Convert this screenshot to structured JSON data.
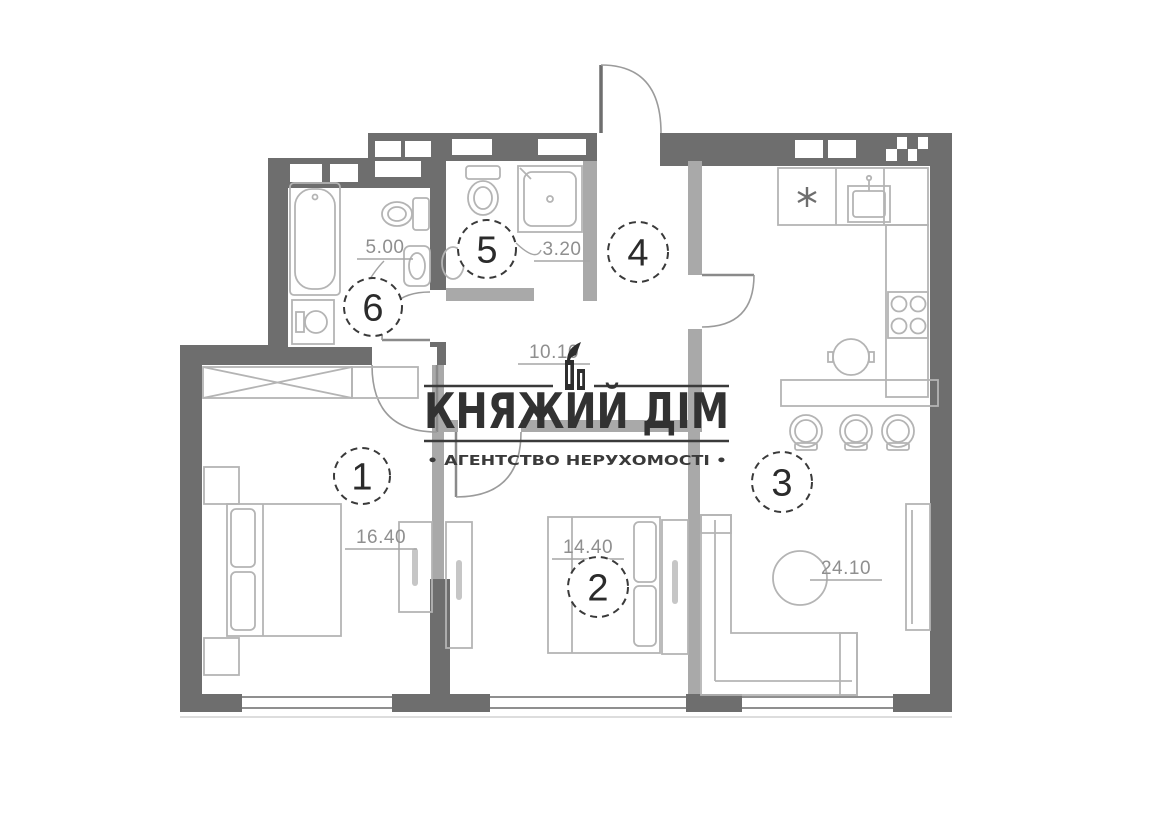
{
  "watermark": {
    "brand": "КНЯЖИЙ ДІМ",
    "tagline": "• АГЕНТСТВО НЕРУХОМОСТІ •",
    "icon": "building-towers-icon",
    "text_color": "#323232"
  },
  "floorplan": {
    "rooms": [
      {
        "number": "1",
        "area": "16.40"
      },
      {
        "number": "2",
        "area": "14.40"
      },
      {
        "number": "3",
        "area": "24.10"
      },
      {
        "number": "4",
        "area": "10.10"
      },
      {
        "number": "5",
        "area": "3.20"
      },
      {
        "number": "6",
        "area": "5.00"
      }
    ],
    "colors": {
      "wall": "#6e6e6e",
      "partition": "#a9a9a9",
      "furniture_line": "#b4b4b4",
      "window_line": "#8f8f8f",
      "marker": "#3a3a3a",
      "area_text": "#8f8f8f",
      "background": "#ffffff"
    }
  }
}
